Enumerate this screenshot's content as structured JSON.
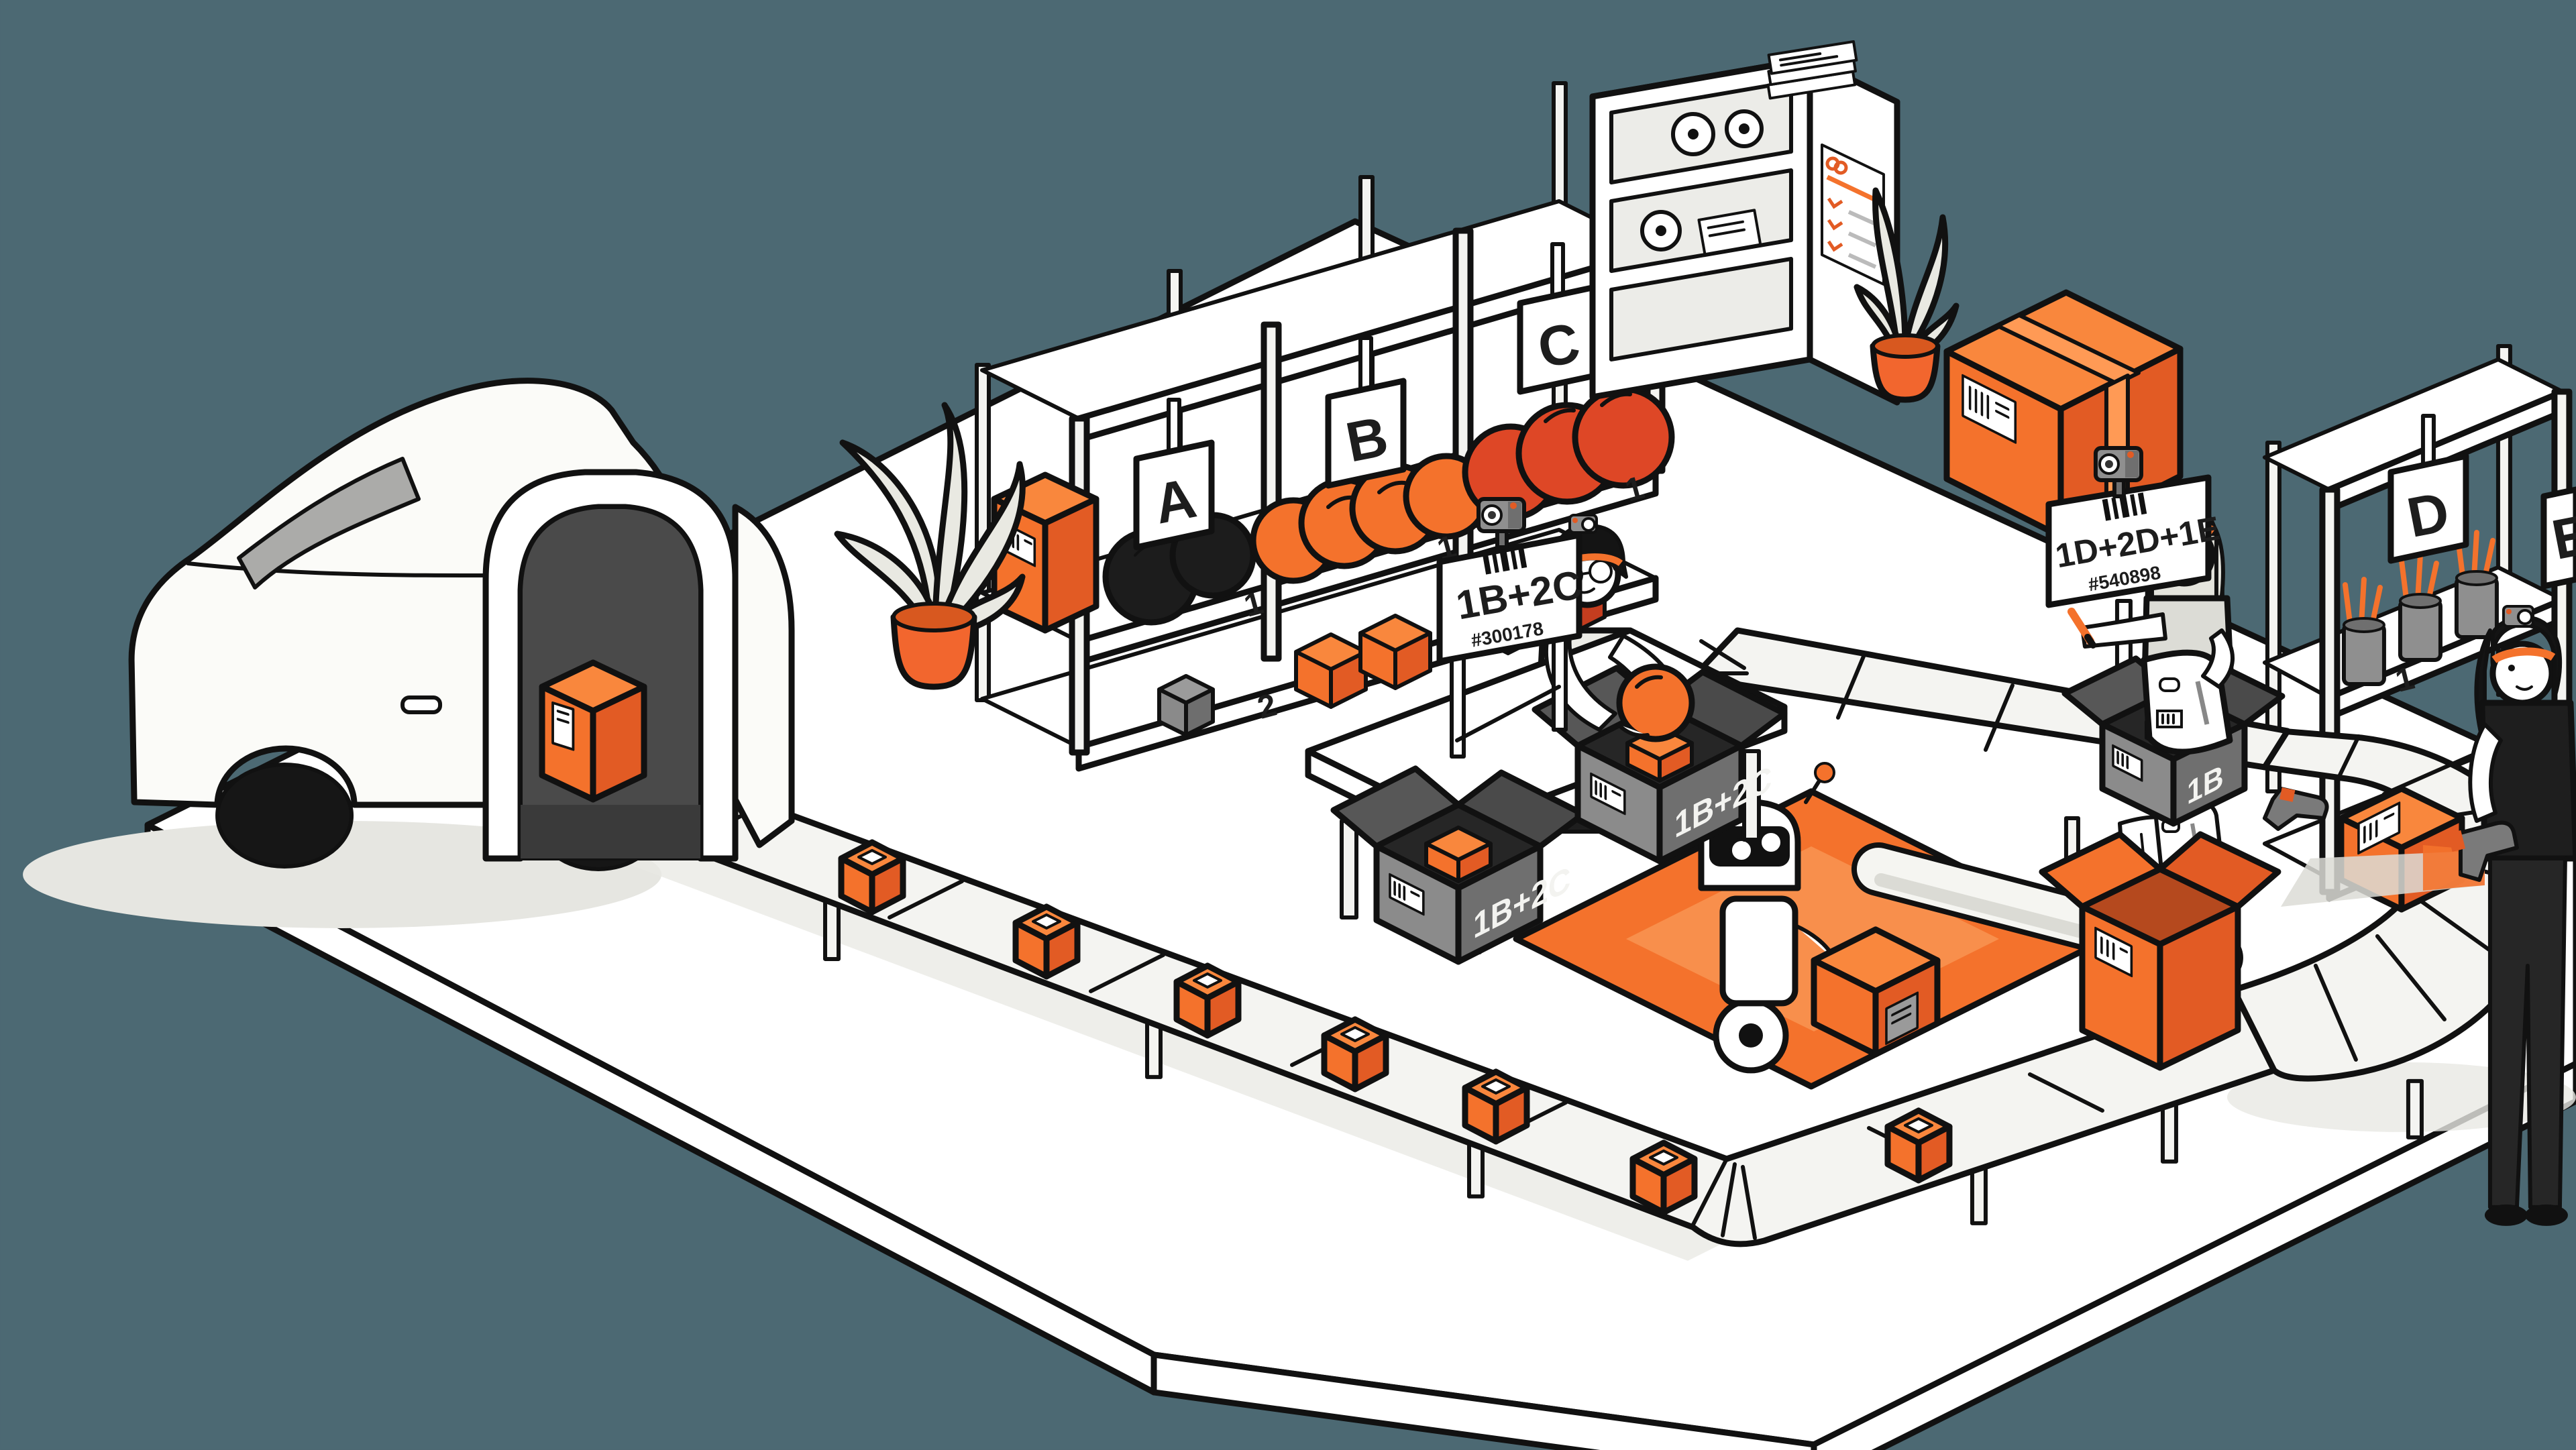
{
  "palette": {
    "background": "#4C6973",
    "orange": "#F4722C",
    "orange_light": "#F9873D",
    "orange_dark": "#E25B24",
    "orange_red": "#DE4726",
    "mat_inner": "#F88F4C",
    "belt": "#F4F4F1",
    "gray_box": "#8B8B8B",
    "outline": "#111111"
  },
  "signs": {
    "station_a": {
      "label": "1B+2C",
      "order_id": "#300178"
    },
    "station_b": {
      "label": "1D+2D+1E",
      "order_id": "#540898"
    }
  },
  "racks": {
    "section_a": {
      "letter": "A",
      "shelf1": "1",
      "shelf2": "2"
    },
    "section_b": {
      "letter": "B",
      "shelf1": "1",
      "shelf2": "2"
    },
    "section_c": {
      "letter": "C",
      "shelf1": "1"
    },
    "section_d": {
      "letter": "D",
      "shelf1": "1",
      "shelf2": "2"
    },
    "section_e": {
      "letter": "E"
    }
  },
  "boxes": {
    "packed_label": "1B+2C",
    "pick_bin_label": "1B"
  }
}
